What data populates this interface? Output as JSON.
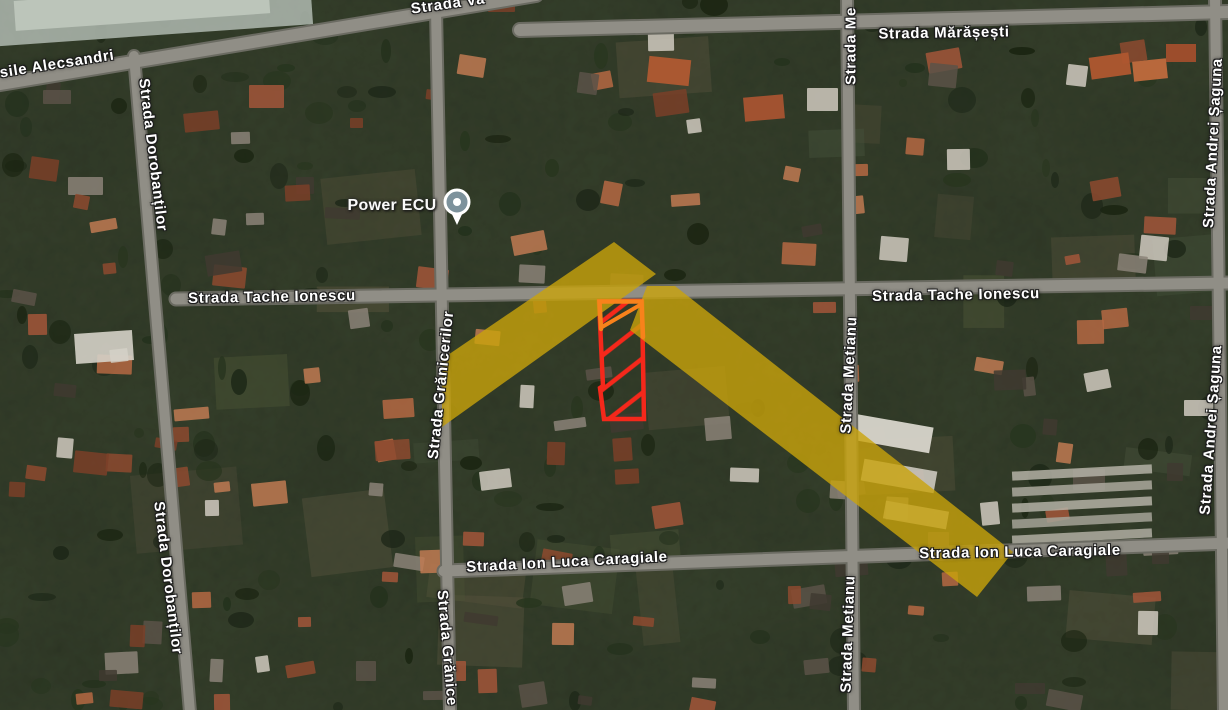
{
  "place": {
    "label": "Power ECU"
  },
  "streets": {
    "labels": [
      {
        "name": "vasile-alecsandri-left",
        "text": "sile Alecsandri"
      },
      {
        "name": "vasile-alecsandri-top",
        "text": "Strada Va"
      },
      {
        "name": "marasesti",
        "text": "Strada Mărășești"
      },
      {
        "name": "metianu-top",
        "text": "Strada Me"
      },
      {
        "name": "dorobantilor-upper",
        "text": "Strada Dorobanților"
      },
      {
        "name": "dorobantilor-lower",
        "text": "Strada Dorobanților"
      },
      {
        "name": "granicerilor-mid",
        "text": "Strada Grănicerilor"
      },
      {
        "name": "granicerilor-bottom",
        "text": "Strada Grănice"
      },
      {
        "name": "tache-ionescu-left",
        "text": "Strada Tache Ionescu"
      },
      {
        "name": "tache-ionescu-right",
        "text": "Strada Tache Ionescu"
      },
      {
        "name": "metianu-mid",
        "text": "Strada Metianu"
      },
      {
        "name": "metianu-bottom",
        "text": "Strada Metianu"
      },
      {
        "name": "andrei-saguna-top",
        "text": "Strada Andrei Șaguna"
      },
      {
        "name": "andrei-saguna-lower",
        "text": "Strada Andrei Șaguna"
      },
      {
        "name": "ion-luca-caragiale-left",
        "text": "Strada Ion Luca Caragiale"
      },
      {
        "name": "ion-luca-caragiale-right",
        "text": "Strada Ion Luca Caragiale"
      }
    ]
  },
  "overlay": {
    "highlight_yellow": "#C9A40B",
    "plot_red": "#F5281B",
    "plot_orange": "#F8821B",
    "pin_fill": "#7D929C",
    "pin_ring": "#FFFFFF"
  }
}
